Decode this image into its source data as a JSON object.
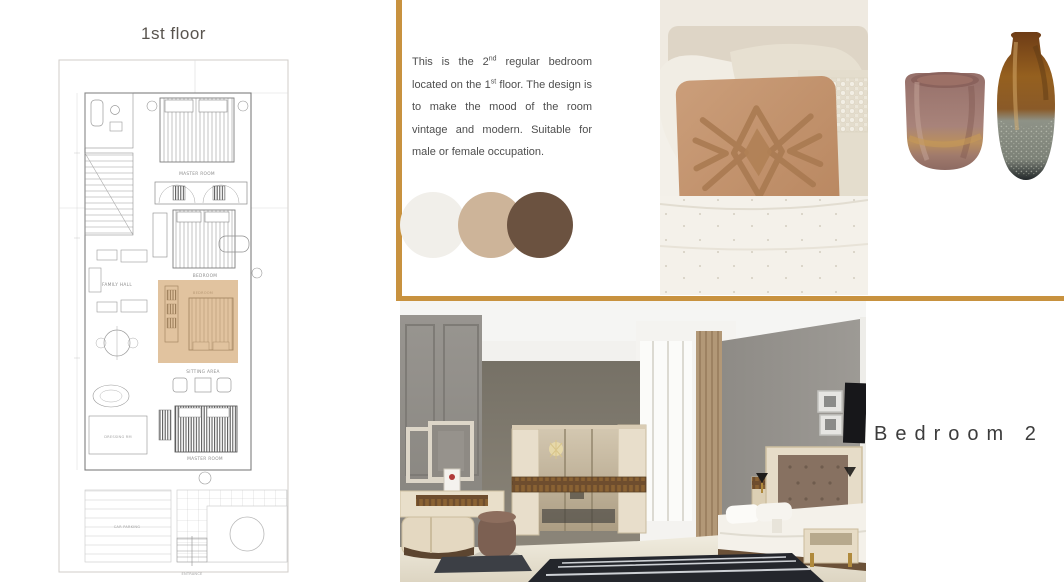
{
  "accent_color": "#c8923f",
  "floor_plan": {
    "title": "1st floor",
    "highlight_color": "#c89150",
    "labels": {
      "master_room_top": "MASTER ROOM",
      "bedroom_top": "BEDROOM",
      "family_hall": "FAMILY HALL",
      "bedroom_highlight": "BEDROOM",
      "sitting_area": "SITTING AREA",
      "master_room_bottom": "MASTER ROOM",
      "dressing_room": "DRESSING RM",
      "car_parking": "CAR PARKING",
      "entrance": "ENTRANCE"
    }
  },
  "description": {
    "part1": "This is the 2",
    "sup1": "nd",
    "part2": " regular bedroom located on the 1",
    "sup2": "st",
    "part3": " floor. The design is to make the mood of the room vintage and modern. Suitable for male or female occupation."
  },
  "palette": {
    "swatches": [
      {
        "name": "off-white",
        "hex": "#f1efea"
      },
      {
        "name": "tan",
        "hex": "#cdb499"
      },
      {
        "name": "brown",
        "hex": "#6b5240"
      }
    ]
  },
  "bedroom_label": "Bedroom 2"
}
